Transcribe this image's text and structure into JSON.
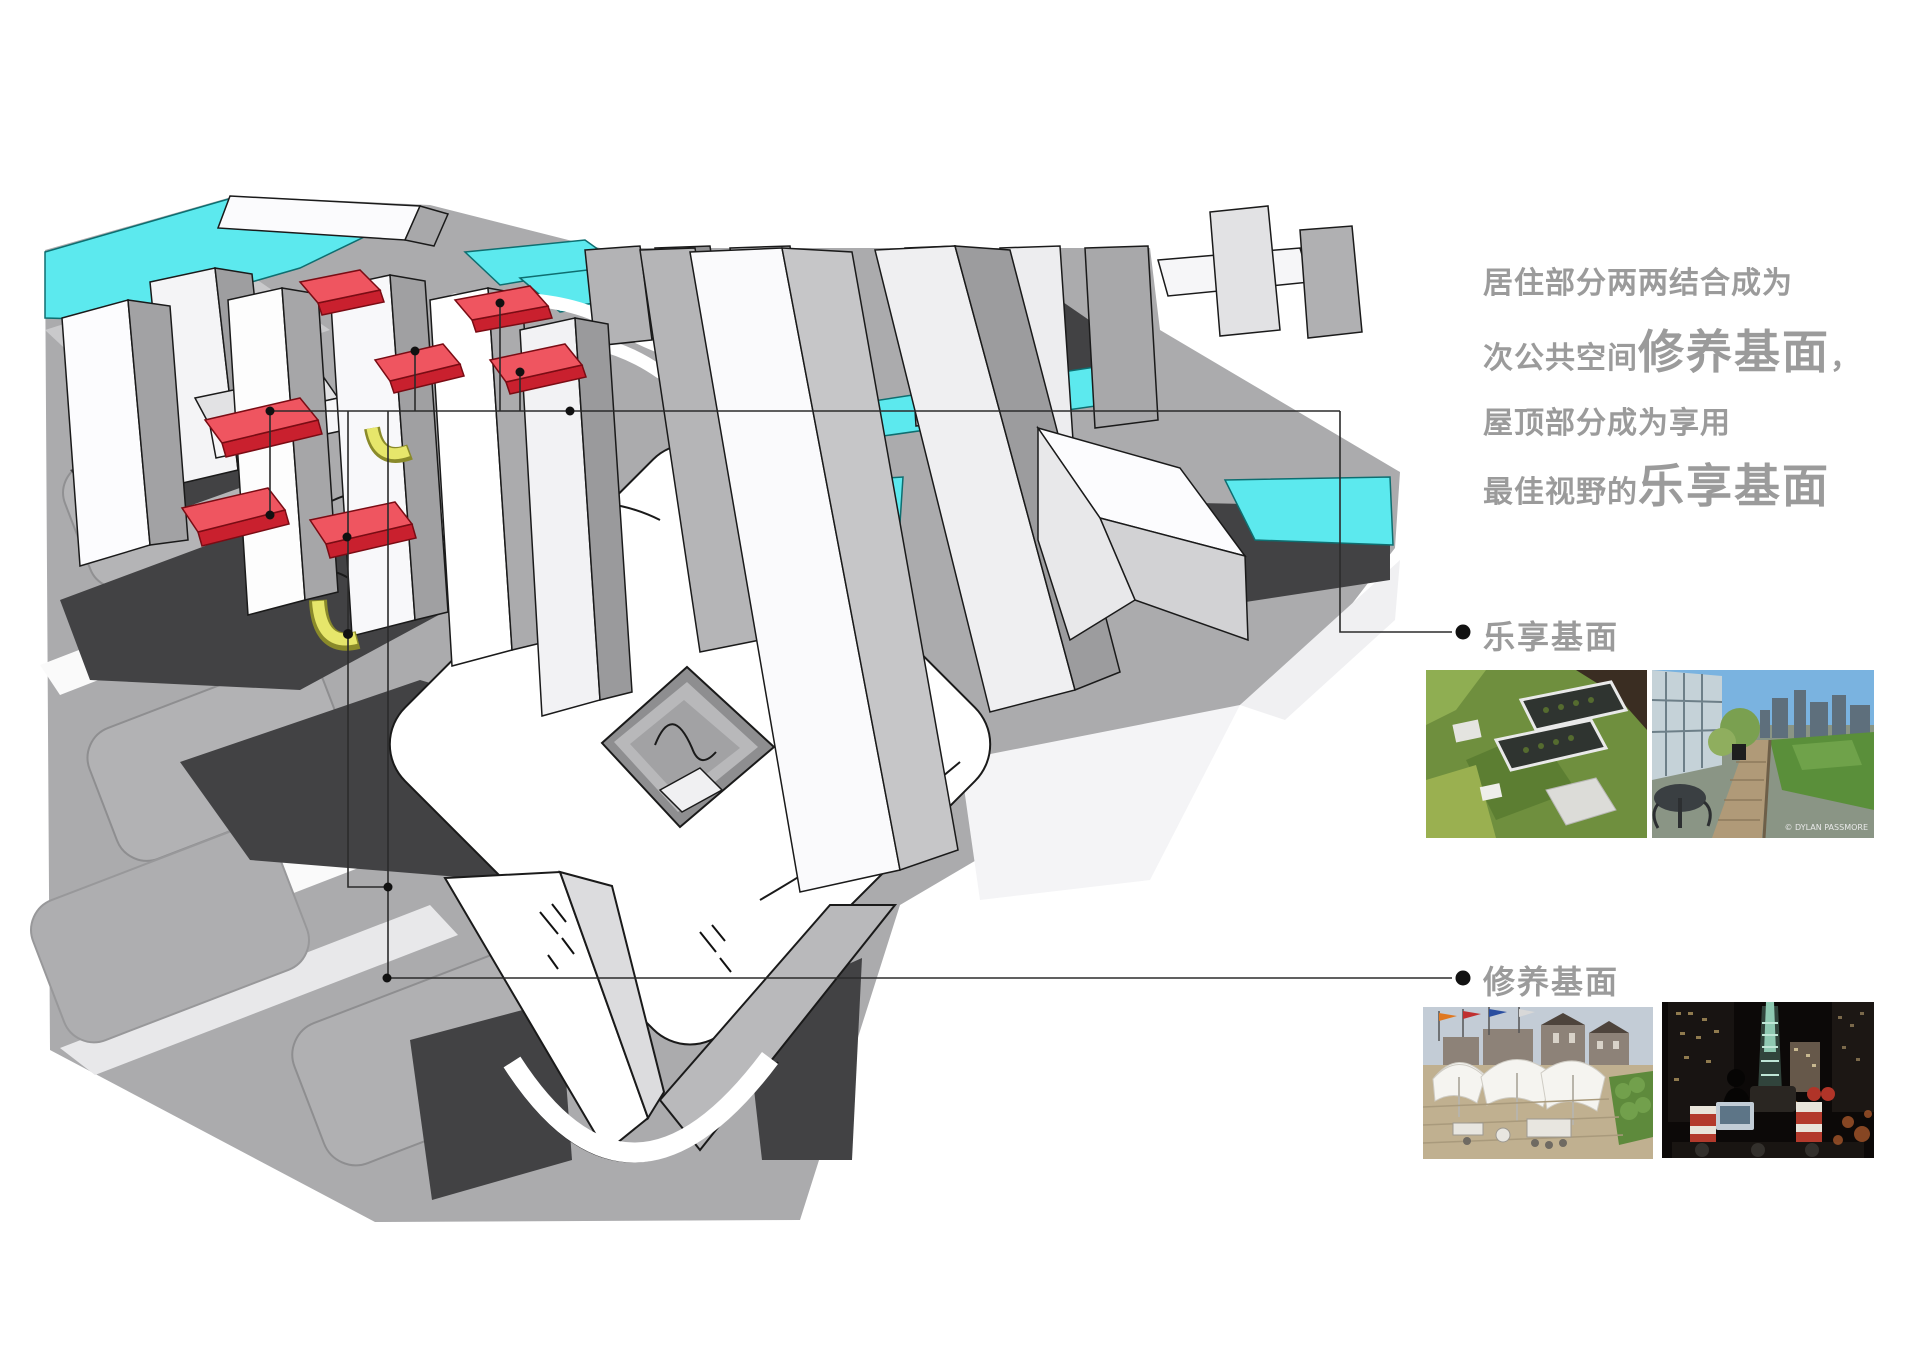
{
  "page": {
    "background": "#ffffff"
  },
  "description_block": {
    "line1": "居住部分两两结合成为",
    "line2_prefix": "次公共空间",
    "line2_emphasis": "修养基面",
    "line2_suffix": "，",
    "line3": "屋顶部分成为享用",
    "line4_prefix": "最佳视野的",
    "line4_emphasis": "乐享基面"
  },
  "callouts": {
    "leisure": {
      "label": "乐享基面"
    },
    "recuperation": {
      "label": "修养基面"
    }
  },
  "photos": {
    "row_leisure": [
      {
        "name": "green-roof-aerial"
      },
      {
        "name": "rooftop-terrace-skyline",
        "watermark": "© DYLAN PASSMORE"
      }
    ],
    "row_recuperation": [
      {
        "name": "terrace-canopies-flags"
      },
      {
        "name": "rooftop-night-dj"
      }
    ]
  },
  "colors": {
    "water_cyan": "#5ce9ee",
    "roof_red": "#ef5560",
    "roof_red_side": "#c9202e",
    "ribbon_yellow": "#e6e66b",
    "text_gray": "#9b9b9b",
    "line_dark": "#2b2b2b",
    "shadow_dark": "#424244",
    "ground_gray": "#ababad"
  }
}
